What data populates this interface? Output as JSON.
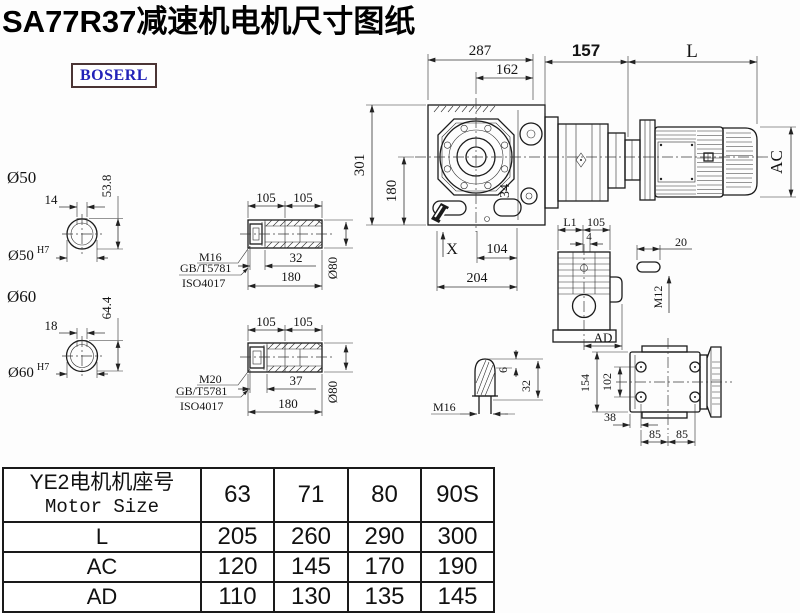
{
  "page": {
    "title": "SA77R37减速机电机尺寸图纸",
    "logo": "BOSERL"
  },
  "main_view": {
    "dim_overall_width": "287",
    "dim_flange_width": "162",
    "dim_adapter_len": "157",
    "dim_motor_len": "L",
    "dim_motor_dia": "AC",
    "dim_overall_height": "301",
    "dim_axis_height": "180",
    "dim_face_width": "34",
    "mark_x": "X",
    "dim_foot_span": "104",
    "dim_base_width": "204"
  },
  "shaft_end_50": {
    "label": "Ø50",
    "key_width": "14",
    "key_depth": "53.8",
    "bore": "Ø50",
    "bore_tol": "H7"
  },
  "shaft_end_60": {
    "label": "Ø60",
    "key_width": "18",
    "key_depth": "64.4",
    "bore": "Ø60",
    "bore_tol": "H7"
  },
  "fastener_note_upper": {
    "thread": "M16",
    "standard": "GB/T5781",
    "iso": "ISO4017"
  },
  "fastener_note_lower": {
    "thread": "M20",
    "standard": "GB/T5781",
    "iso": "ISO4017"
  },
  "hollow_shaft_upper": {
    "dim_left": "105",
    "dim_right": "105",
    "dim_bolt_len": "32",
    "dim_total_len": "180",
    "dim_dia": "Ø80"
  },
  "hollow_shaft_lower": {
    "dim_left": "105",
    "dim_right": "105",
    "dim_bolt_len": "37",
    "dim_total_len": "180",
    "dim_dia": "Ø80"
  },
  "plug_detail": {
    "thread": "M16",
    "dim_tip": "6",
    "dim_len": "32"
  },
  "side_view": {
    "dim_l1": "L1",
    "dim_105": "105",
    "dim_4": "4",
    "dim_ad": "AD",
    "dim_key_len": "20",
    "thread": "M12"
  },
  "rear_view": {
    "dim_height": "154",
    "dim_hole_span_v": "102",
    "dim_edge": "38",
    "dim_hole_left": "85",
    "dim_hole_right": "85"
  },
  "size_table": {
    "header_line1": "YE2电机机座号",
    "header_line2": "Motor Size",
    "sizes": [
      "63",
      "71",
      "80",
      "90S"
    ],
    "rows": [
      {
        "label": "L",
        "values": [
          "205",
          "260",
          "290",
          "300"
        ]
      },
      {
        "label": "AC",
        "values": [
          "120",
          "145",
          "170",
          "190"
        ]
      },
      {
        "label": "AD",
        "values": [
          "110",
          "130",
          "135",
          "145"
        ]
      }
    ]
  }
}
